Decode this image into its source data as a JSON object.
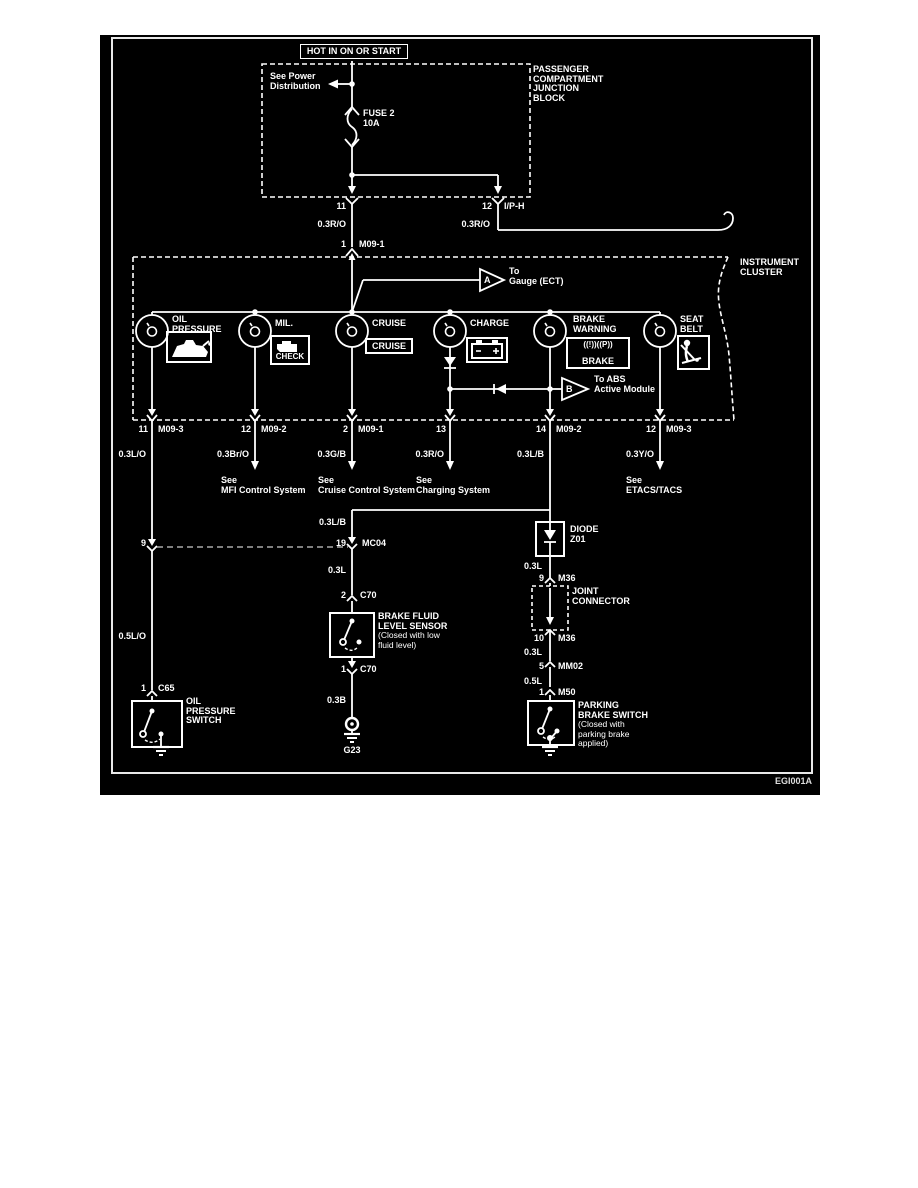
{
  "colors": {
    "background": "#000000",
    "line": "#ffffff"
  },
  "footer_code": "EGI001A",
  "power": {
    "hot": "HOT IN ON OR START",
    "see_power": "See Power Distribution",
    "junction_block": "PASSENGER COMPARTMENT JUNCTION BLOCK",
    "fuse_name": "FUSE 2",
    "fuse_rating": "10A",
    "pin11": "11",
    "pin12": "12",
    "iph": "I/P-H",
    "wire11": "0.3R/O",
    "wire12": "0.3R/O",
    "pin1": "1",
    "m091": "M09-1"
  },
  "cluster": {
    "label": "INSTRUMENT CLUSTER",
    "tri_a_letter": "A",
    "tri_a_to": "To",
    "tri_a_target": "Gauge (ECT)",
    "tri_b_letter": "B",
    "tri_b_line1": "To ABS",
    "tri_b_line2": "Active Module",
    "lamps": [
      {
        "name": "OIL PRESSURE"
      },
      {
        "name": "MIL.",
        "icon": "CHECK"
      },
      {
        "name": "CRUISE",
        "icon": "CRUISE"
      },
      {
        "name": "CHARGE"
      },
      {
        "name": "BRAKE WARNING",
        "icon_sym": "((!))((P))",
        "icon": "BRAKE"
      },
      {
        "name": "SEAT BELT"
      }
    ]
  },
  "row2": {
    "pins": [
      {
        "pin": "11",
        "name": "M09-3"
      },
      {
        "pin": "12",
        "name": "M09-2"
      },
      {
        "pin": "2",
        "name": "M09-1"
      },
      {
        "pin": "13",
        "name": ""
      },
      {
        "pin": "14",
        "name": "M09-2"
      },
      {
        "pin": "12",
        "name": "M09-3"
      }
    ],
    "wires": [
      "0.3L/O",
      "0.3Br/O",
      "0.3G/B",
      "0.3R/O",
      "0.3L/B",
      "0.3Y/O"
    ],
    "see": "See",
    "refs": [
      "MFI Control System",
      "Cruise Control System",
      "Charging System",
      "ETACS/TACS"
    ]
  },
  "left_branch": {
    "pin9": "9",
    "wire": "0.5L/O",
    "pin1": "1",
    "conn": "C65",
    "name": "OIL PRESSURE SWITCH"
  },
  "center_branch": {
    "wire_lb": "0.3L/B",
    "pin19": "19",
    "mc04": "MC04",
    "wire_l": "0.3L",
    "pin2": "2",
    "c70": "C70",
    "name": "BRAKE FLUID LEVEL SENSOR",
    "note": "(Closed with low fluid level)",
    "pin1": "1",
    "c70b": "C70",
    "wire_b": "0.3B",
    "ground": "G23"
  },
  "right_branch": {
    "diode": "DIODE",
    "z01": "Z01",
    "wire_l1": "0.3L",
    "pin9": "9",
    "m36": "M36",
    "joint": "JOINT CONNECTOR",
    "pin10": "10",
    "m36b": "M36",
    "wire_l2": "0.3L",
    "pin5": "5",
    "mm02": "MM02",
    "wire_5l": "0.5L",
    "pin1": "1",
    "m50": "M50",
    "name": "PARKING BRAKE SWITCH",
    "note": "(Closed with parking brake applied)"
  }
}
